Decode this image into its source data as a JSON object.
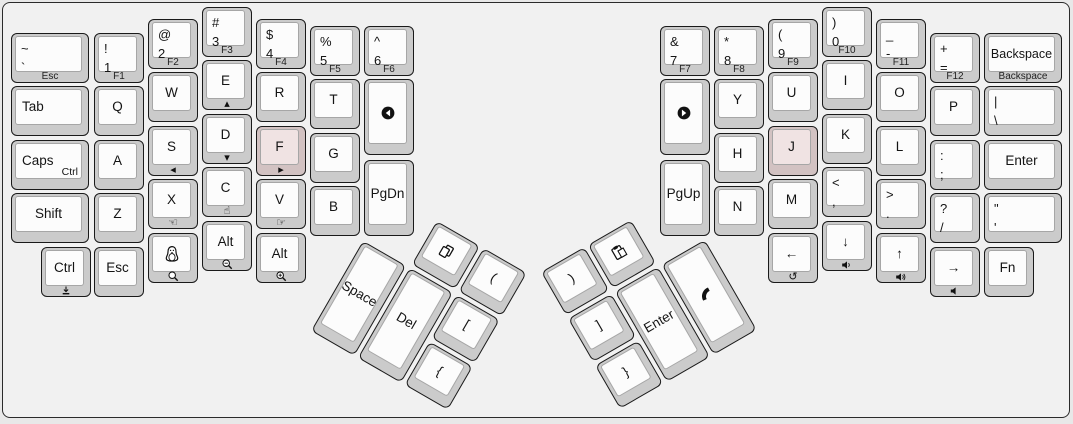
{
  "app": "keyboard-layout",
  "colors": {
    "pageBg": "#e8e8e8",
    "panelBg": "#f1f1f1",
    "panelBorder": "#2b2b2b",
    "cap": "#cbcbcb",
    "capBorder": "#1a1a1a",
    "top": "#fcfcfc",
    "topBorder": "#a6a6a6",
    "highlightCap": "#d2c2c2",
    "highlightTop": "#f0e3e3",
    "text": "#141414"
  },
  "keys": [
    {
      "id": "grave",
      "x": 11,
      "y": 33,
      "w": 78,
      "h": 50,
      "label": [
        "~",
        "`"
      ],
      "front": "Esc"
    },
    {
      "id": "tab",
      "x": 11,
      "y": 86,
      "w": 78,
      "h": 50,
      "label": "Tab",
      "align": "left"
    },
    {
      "id": "caps",
      "x": 11,
      "y": 140,
      "w": 78,
      "h": 50,
      "label": "Caps",
      "align": "left",
      "corner": "Ctrl"
    },
    {
      "id": "shift-left",
      "x": 11,
      "y": 193,
      "w": 78,
      "h": 50,
      "label": "Shift"
    },
    {
      "id": "ctrl-bottom",
      "x": 41,
      "y": 247,
      "w": 50,
      "h": 50,
      "label": "Ctrl",
      "front_icon": "download-icon"
    },
    {
      "id": "1",
      "x": 94,
      "y": 33,
      "w": 50,
      "h": 50,
      "label": [
        "!",
        "1"
      ],
      "front": "F1"
    },
    {
      "id": "q",
      "x": 94,
      "y": 86,
      "w": 50,
      "h": 50,
      "label": "Q"
    },
    {
      "id": "a",
      "x": 94,
      "y": 140,
      "w": 50,
      "h": 50,
      "label": "A"
    },
    {
      "id": "z",
      "x": 94,
      "y": 193,
      "w": 50,
      "h": 50,
      "label": "Z"
    },
    {
      "id": "esc-bottom",
      "x": 94,
      "y": 247,
      "w": 50,
      "h": 50,
      "label": "Esc"
    },
    {
      "id": "2",
      "x": 148,
      "y": 19,
      "w": 50,
      "h": 50,
      "label": [
        "@",
        "2"
      ],
      "front": "F2"
    },
    {
      "id": "w",
      "x": 148,
      "y": 72,
      "w": 50,
      "h": 50,
      "label": "W"
    },
    {
      "id": "s",
      "x": 148,
      "y": 126,
      "w": 50,
      "h": 50,
      "label": "S",
      "front_icon": "triangle-left-icon"
    },
    {
      "id": "x",
      "x": 148,
      "y": 179,
      "w": 50,
      "h": 50,
      "label": "X",
      "front_icon": "hand-left-icon"
    },
    {
      "id": "super-tux",
      "x": 148,
      "y": 233,
      "w": 50,
      "h": 50,
      "icon": "penguin-icon",
      "front_icon": "search-icon"
    },
    {
      "id": "3",
      "x": 202,
      "y": 7,
      "w": 50,
      "h": 50,
      "label": [
        "#",
        "3"
      ],
      "front": "F3"
    },
    {
      "id": "e",
      "x": 202,
      "y": 60,
      "w": 50,
      "h": 50,
      "label": "E",
      "front_icon": "triangle-up-icon"
    },
    {
      "id": "d",
      "x": 202,
      "y": 114,
      "w": 50,
      "h": 50,
      "label": "D",
      "front_icon": "triangle-down-icon"
    },
    {
      "id": "c",
      "x": 202,
      "y": 167,
      "w": 50,
      "h": 50,
      "label": "C",
      "front_icon": "hand-up-icon"
    },
    {
      "id": "alt-left-1",
      "x": 202,
      "y": 221,
      "w": 50,
      "h": 50,
      "label": "Alt",
      "front_icon": "search-minus-icon"
    },
    {
      "id": "4",
      "x": 256,
      "y": 19,
      "w": 50,
      "h": 50,
      "label": [
        "$",
        "4"
      ],
      "front": "F4"
    },
    {
      "id": "r",
      "x": 256,
      "y": 72,
      "w": 50,
      "h": 50,
      "label": "R"
    },
    {
      "id": "f",
      "x": 256,
      "y": 126,
      "w": 50,
      "h": 50,
      "label": "F",
      "front_icon": "triangle-right-icon",
      "highlight": true
    },
    {
      "id": "v",
      "x": 256,
      "y": 179,
      "w": 50,
      "h": 50,
      "label": "V",
      "front_icon": "hand-right-icon"
    },
    {
      "id": "alt-left-2",
      "x": 256,
      "y": 233,
      "w": 50,
      "h": 50,
      "label": "Alt",
      "front_icon": "search-plus-icon"
    },
    {
      "id": "5",
      "x": 310,
      "y": 26,
      "w": 50,
      "h": 50,
      "label": [
        "%",
        "5"
      ],
      "front": "F5"
    },
    {
      "id": "t",
      "x": 310,
      "y": 79,
      "w": 50,
      "h": 50,
      "label": "T"
    },
    {
      "id": "g",
      "x": 310,
      "y": 133,
      "w": 50,
      "h": 50,
      "label": "G"
    },
    {
      "id": "b",
      "x": 310,
      "y": 186,
      "w": 50,
      "h": 50,
      "label": "B"
    },
    {
      "id": "6",
      "x": 364,
      "y": 26,
      "w": 50,
      "h": 50,
      "label": [
        "^",
        "6"
      ],
      "front": "F6"
    },
    {
      "id": "media-prev",
      "x": 364,
      "y": 79,
      "w": 50,
      "h": 76,
      "icon": "circle-arrow-left-icon"
    },
    {
      "id": "pgdn",
      "x": 364,
      "y": 160,
      "w": 50,
      "h": 76,
      "label": "PgDn"
    },
    {
      "id": "7",
      "x": 660,
      "y": 26,
      "w": 50,
      "h": 50,
      "label": [
        "&",
        "7"
      ],
      "front": "F7"
    },
    {
      "id": "media-next",
      "x": 660,
      "y": 79,
      "w": 50,
      "h": 76,
      "icon": "circle-arrow-right-icon"
    },
    {
      "id": "pgup",
      "x": 660,
      "y": 160,
      "w": 50,
      "h": 76,
      "label": "PgUp"
    },
    {
      "id": "8",
      "x": 714,
      "y": 26,
      "w": 50,
      "h": 50,
      "label": [
        "*",
        "8"
      ],
      "front": "F8"
    },
    {
      "id": "y",
      "x": 714,
      "y": 79,
      "w": 50,
      "h": 50,
      "label": "Y"
    },
    {
      "id": "h",
      "x": 714,
      "y": 133,
      "w": 50,
      "h": 50,
      "label": "H"
    },
    {
      "id": "n",
      "x": 714,
      "y": 186,
      "w": 50,
      "h": 50,
      "label": "N"
    },
    {
      "id": "9",
      "x": 768,
      "y": 19,
      "w": 50,
      "h": 50,
      "label": [
        "(",
        "9"
      ],
      "front": "F9"
    },
    {
      "id": "u",
      "x": 768,
      "y": 72,
      "w": 50,
      "h": 50,
      "label": "U"
    },
    {
      "id": "j",
      "x": 768,
      "y": 126,
      "w": 50,
      "h": 50,
      "label": "J",
      "highlight": true
    },
    {
      "id": "m",
      "x": 768,
      "y": 179,
      "w": 50,
      "h": 50,
      "label": "M"
    },
    {
      "id": "arrow-left",
      "x": 768,
      "y": 233,
      "w": 50,
      "h": 50,
      "label": "←",
      "front_icon": "undo-icon"
    },
    {
      "id": "0",
      "x": 822,
      "y": 7,
      "w": 50,
      "h": 50,
      "label": [
        ")",
        "0"
      ],
      "front": "F10"
    },
    {
      "id": "i",
      "x": 822,
      "y": 60,
      "w": 50,
      "h": 50,
      "label": "I"
    },
    {
      "id": "k",
      "x": 822,
      "y": 114,
      "w": 50,
      "h": 50,
      "label": "K"
    },
    {
      "id": "comma",
      "x": 822,
      "y": 167,
      "w": 50,
      "h": 50,
      "label": [
        "<",
        ","
      ]
    },
    {
      "id": "arrow-down",
      "x": 822,
      "y": 221,
      "w": 50,
      "h": 50,
      "label": "↓",
      "front_icon": "volume-down-icon"
    },
    {
      "id": "minus",
      "x": 876,
      "y": 19,
      "w": 50,
      "h": 50,
      "label": [
        "_",
        "-"
      ],
      "front": "F11"
    },
    {
      "id": "o",
      "x": 876,
      "y": 72,
      "w": 50,
      "h": 50,
      "label": "O"
    },
    {
      "id": "l",
      "x": 876,
      "y": 126,
      "w": 50,
      "h": 50,
      "label": "L"
    },
    {
      "id": "period",
      "x": 876,
      "y": 179,
      "w": 50,
      "h": 50,
      "label": [
        ">",
        "."
      ]
    },
    {
      "id": "arrow-up",
      "x": 876,
      "y": 233,
      "w": 50,
      "h": 50,
      "label": "↑",
      "front_icon": "volume-up-icon"
    },
    {
      "id": "equals",
      "x": 930,
      "y": 33,
      "w": 50,
      "h": 50,
      "label": [
        "+",
        "="
      ],
      "front": "F12"
    },
    {
      "id": "p",
      "x": 930,
      "y": 86,
      "w": 50,
      "h": 50,
      "label": "P"
    },
    {
      "id": "semicolon",
      "x": 930,
      "y": 140,
      "w": 50,
      "h": 50,
      "label": [
        ":",
        ";"
      ]
    },
    {
      "id": "slash",
      "x": 930,
      "y": 193,
      "w": 50,
      "h": 50,
      "label": [
        "?",
        "/"
      ]
    },
    {
      "id": "arrow-right",
      "x": 930,
      "y": 247,
      "w": 50,
      "h": 50,
      "label": "→",
      "front_icon": "volume-mute-icon"
    },
    {
      "id": "backspace",
      "x": 984,
      "y": 33,
      "w": 78,
      "h": 50,
      "label": "Backspace",
      "small": true,
      "front": "Backspace"
    },
    {
      "id": "backslash",
      "x": 984,
      "y": 86,
      "w": 78,
      "h": 50,
      "label": [
        "|",
        "\\"
      ]
    },
    {
      "id": "enter-right",
      "x": 984,
      "y": 140,
      "w": 78,
      "h": 50,
      "label": "Enter"
    },
    {
      "id": "quote",
      "x": 984,
      "y": 193,
      "w": 78,
      "h": 50,
      "label": [
        "\"",
        "'"
      ]
    },
    {
      "id": "fn",
      "x": 984,
      "y": 247,
      "w": 50,
      "h": 50,
      "label": "Fn"
    }
  ],
  "clusters": [
    {
      "id": "left-thumb",
      "x": 390,
      "y": 194,
      "angle": 30,
      "keys": [
        {
          "id": "copy",
          "x": 54,
          "y": 0,
          "w": 50,
          "h": 50,
          "icon": "copy-icon"
        },
        {
          "id": "paren-left",
          "x": 108,
          "y": 0,
          "w": 50,
          "h": 50,
          "label": "("
        },
        {
          "id": "space",
          "x": 0,
          "y": 54,
          "w": 50,
          "h": 104,
          "label": "Space"
        },
        {
          "id": "delete",
          "x": 54,
          "y": 54,
          "w": 50,
          "h": 104,
          "label": "Del"
        },
        {
          "id": "bracket-left",
          "x": 108,
          "y": 54,
          "w": 50,
          "h": 50,
          "label": "["
        },
        {
          "id": "brace-left",
          "x": 108,
          "y": 108,
          "w": 50,
          "h": 50,
          "label": "{"
        }
      ]
    },
    {
      "id": "right-thumb",
      "x": 541,
      "y": 272,
      "angle": -30,
      "keys": [
        {
          "id": "paren-right",
          "x": 0,
          "y": 0,
          "w": 50,
          "h": 50,
          "label": ")"
        },
        {
          "id": "paste",
          "x": 54,
          "y": 0,
          "w": 50,
          "h": 50,
          "icon": "paste-icon"
        },
        {
          "id": "bracket-right",
          "x": 0,
          "y": 54,
          "w": 50,
          "h": 50,
          "label": "]"
        },
        {
          "id": "brace-right",
          "x": 0,
          "y": 108,
          "w": 50,
          "h": 50,
          "label": "}"
        },
        {
          "id": "enter-thumb",
          "x": 54,
          "y": 54,
          "w": 50,
          "h": 104,
          "label": "Enter"
        },
        {
          "id": "phone",
          "x": 108,
          "y": 54,
          "w": 50,
          "h": 104,
          "icon": "phone-icon"
        }
      ]
    }
  ]
}
